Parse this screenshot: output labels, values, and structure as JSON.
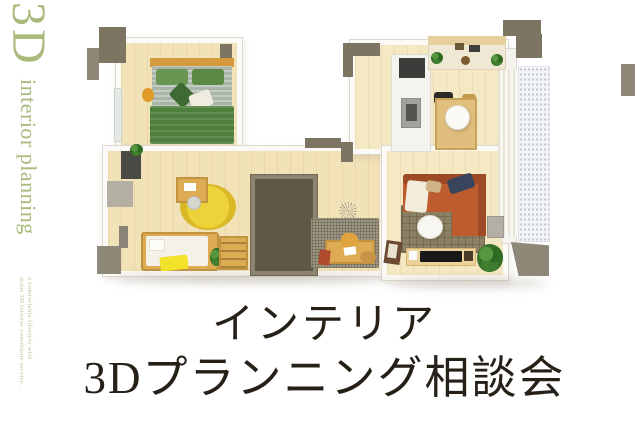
{
  "poster": {
    "brand": {
      "logo": "3D",
      "logo_text": "interior planning",
      "tagline_line1": "a comfortable lifestyle with",
      "tagline_line2": "actus 3D interior coordinate service."
    },
    "headline": {
      "line1": "インテリア",
      "line2": "3Dプランニング相談会"
    }
  },
  "floorplan": {
    "type": "3d-apartment-render",
    "rooms": [
      "bedroom",
      "kids-room",
      "hallway",
      "walk-in-closet",
      "study-nook",
      "kitchen",
      "dining-area",
      "living-room",
      "balcony"
    ]
  },
  "theme": {
    "olive": "#a9ba7c",
    "ink": "#262019",
    "wall": "#fbfaf6",
    "wall-edge": "#dcd8cd",
    "floor": "#f2e2b8",
    "floor-ldk": "#f5e9c4",
    "cap": "#7c7562",
    "cap-light": "#8d8878",
    "closet": "#5e5847",
    "closet-edge": "#8c8470",
    "sofa": "#bd5c2e",
    "sofa-dark": "#9e4a24",
    "bed-green": "#4f7f3d",
    "kids-yellow": "#f2e22c",
    "wood": "#dcab52",
    "rug-living": "#8c8165",
    "rug-study": "#99937f"
  }
}
